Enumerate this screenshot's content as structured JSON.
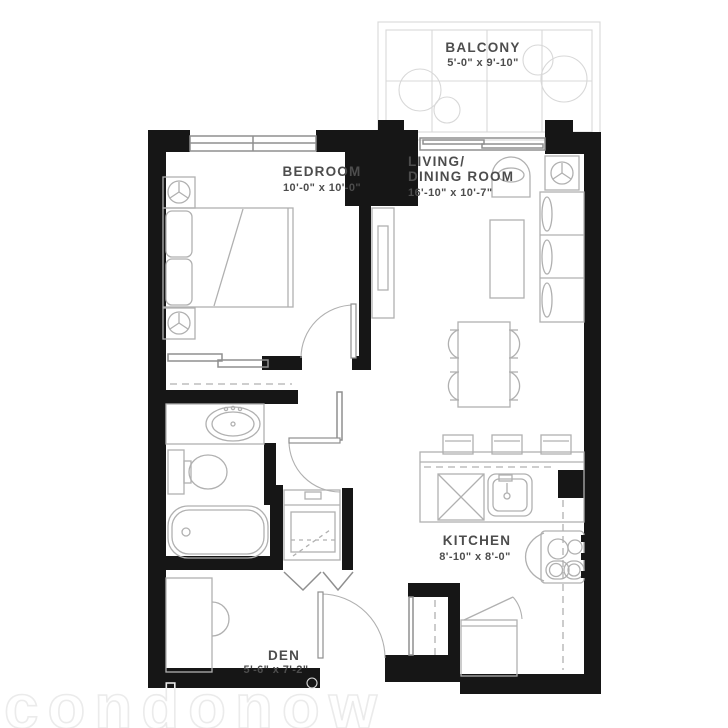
{
  "floorplan": {
    "watermark": "condonow",
    "colors": {
      "wall": "#161616",
      "furniture": "#b0b0b0",
      "fixture": "#8f8f8f",
      "light": "#d8d8d8",
      "label": "#4d4d4d",
      "watermark_color": "#ebebeb"
    },
    "rooms": [
      {
        "name": "BALCONY",
        "dims": "5'-0\" x 9'-10\""
      },
      {
        "name": "BEDROOM",
        "dims": "10'-0\" x 10'-0\""
      },
      {
        "name": "LIVING/",
        "name2": "DINING ROOM",
        "dims": "16'-10\" x 10'-7\""
      },
      {
        "name": "KITCHEN",
        "dims": "8'-10\" x 8'-0\""
      },
      {
        "name": "DEN",
        "dims": "5'-6\" x 7'-2\""
      }
    ]
  }
}
